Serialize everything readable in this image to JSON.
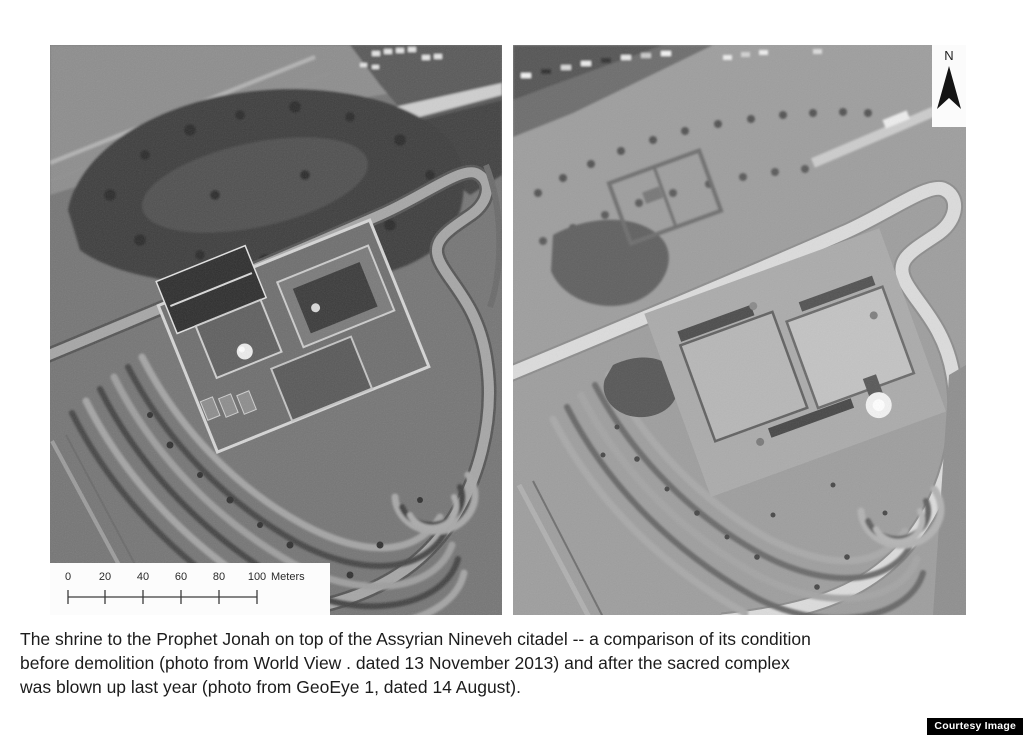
{
  "colors": {
    "page_bg": "#ffffff",
    "before_panel_base": "#757575",
    "after_panel_base": "#9e9e9e",
    "credit_bg": "#000000",
    "credit_text": "#ffffff",
    "caption_text": "#1c1c1c"
  },
  "panels": [
    {
      "name": "satellite-photo-before"
    },
    {
      "name": "satellite-photo-after"
    }
  ],
  "scalebar": {
    "tick_labels": [
      "0",
      "20",
      "40",
      "60",
      "80",
      "100"
    ],
    "unit_label": "Meters"
  },
  "north": {
    "label": "N",
    "icon": "north-arrow-icon"
  },
  "caption": {
    "lines": [
      "The shrine to the Prophet Jonah on top of the Assyrian Nineveh citadel -- a comparison of its condition",
      "before demolition (photo from World View . dated 13 November 2013) and after the sacred complex",
      "was blown up last year (photo from GeoEye 1, dated 14 August)."
    ]
  },
  "credit": {
    "label": "Courtesy Image"
  }
}
